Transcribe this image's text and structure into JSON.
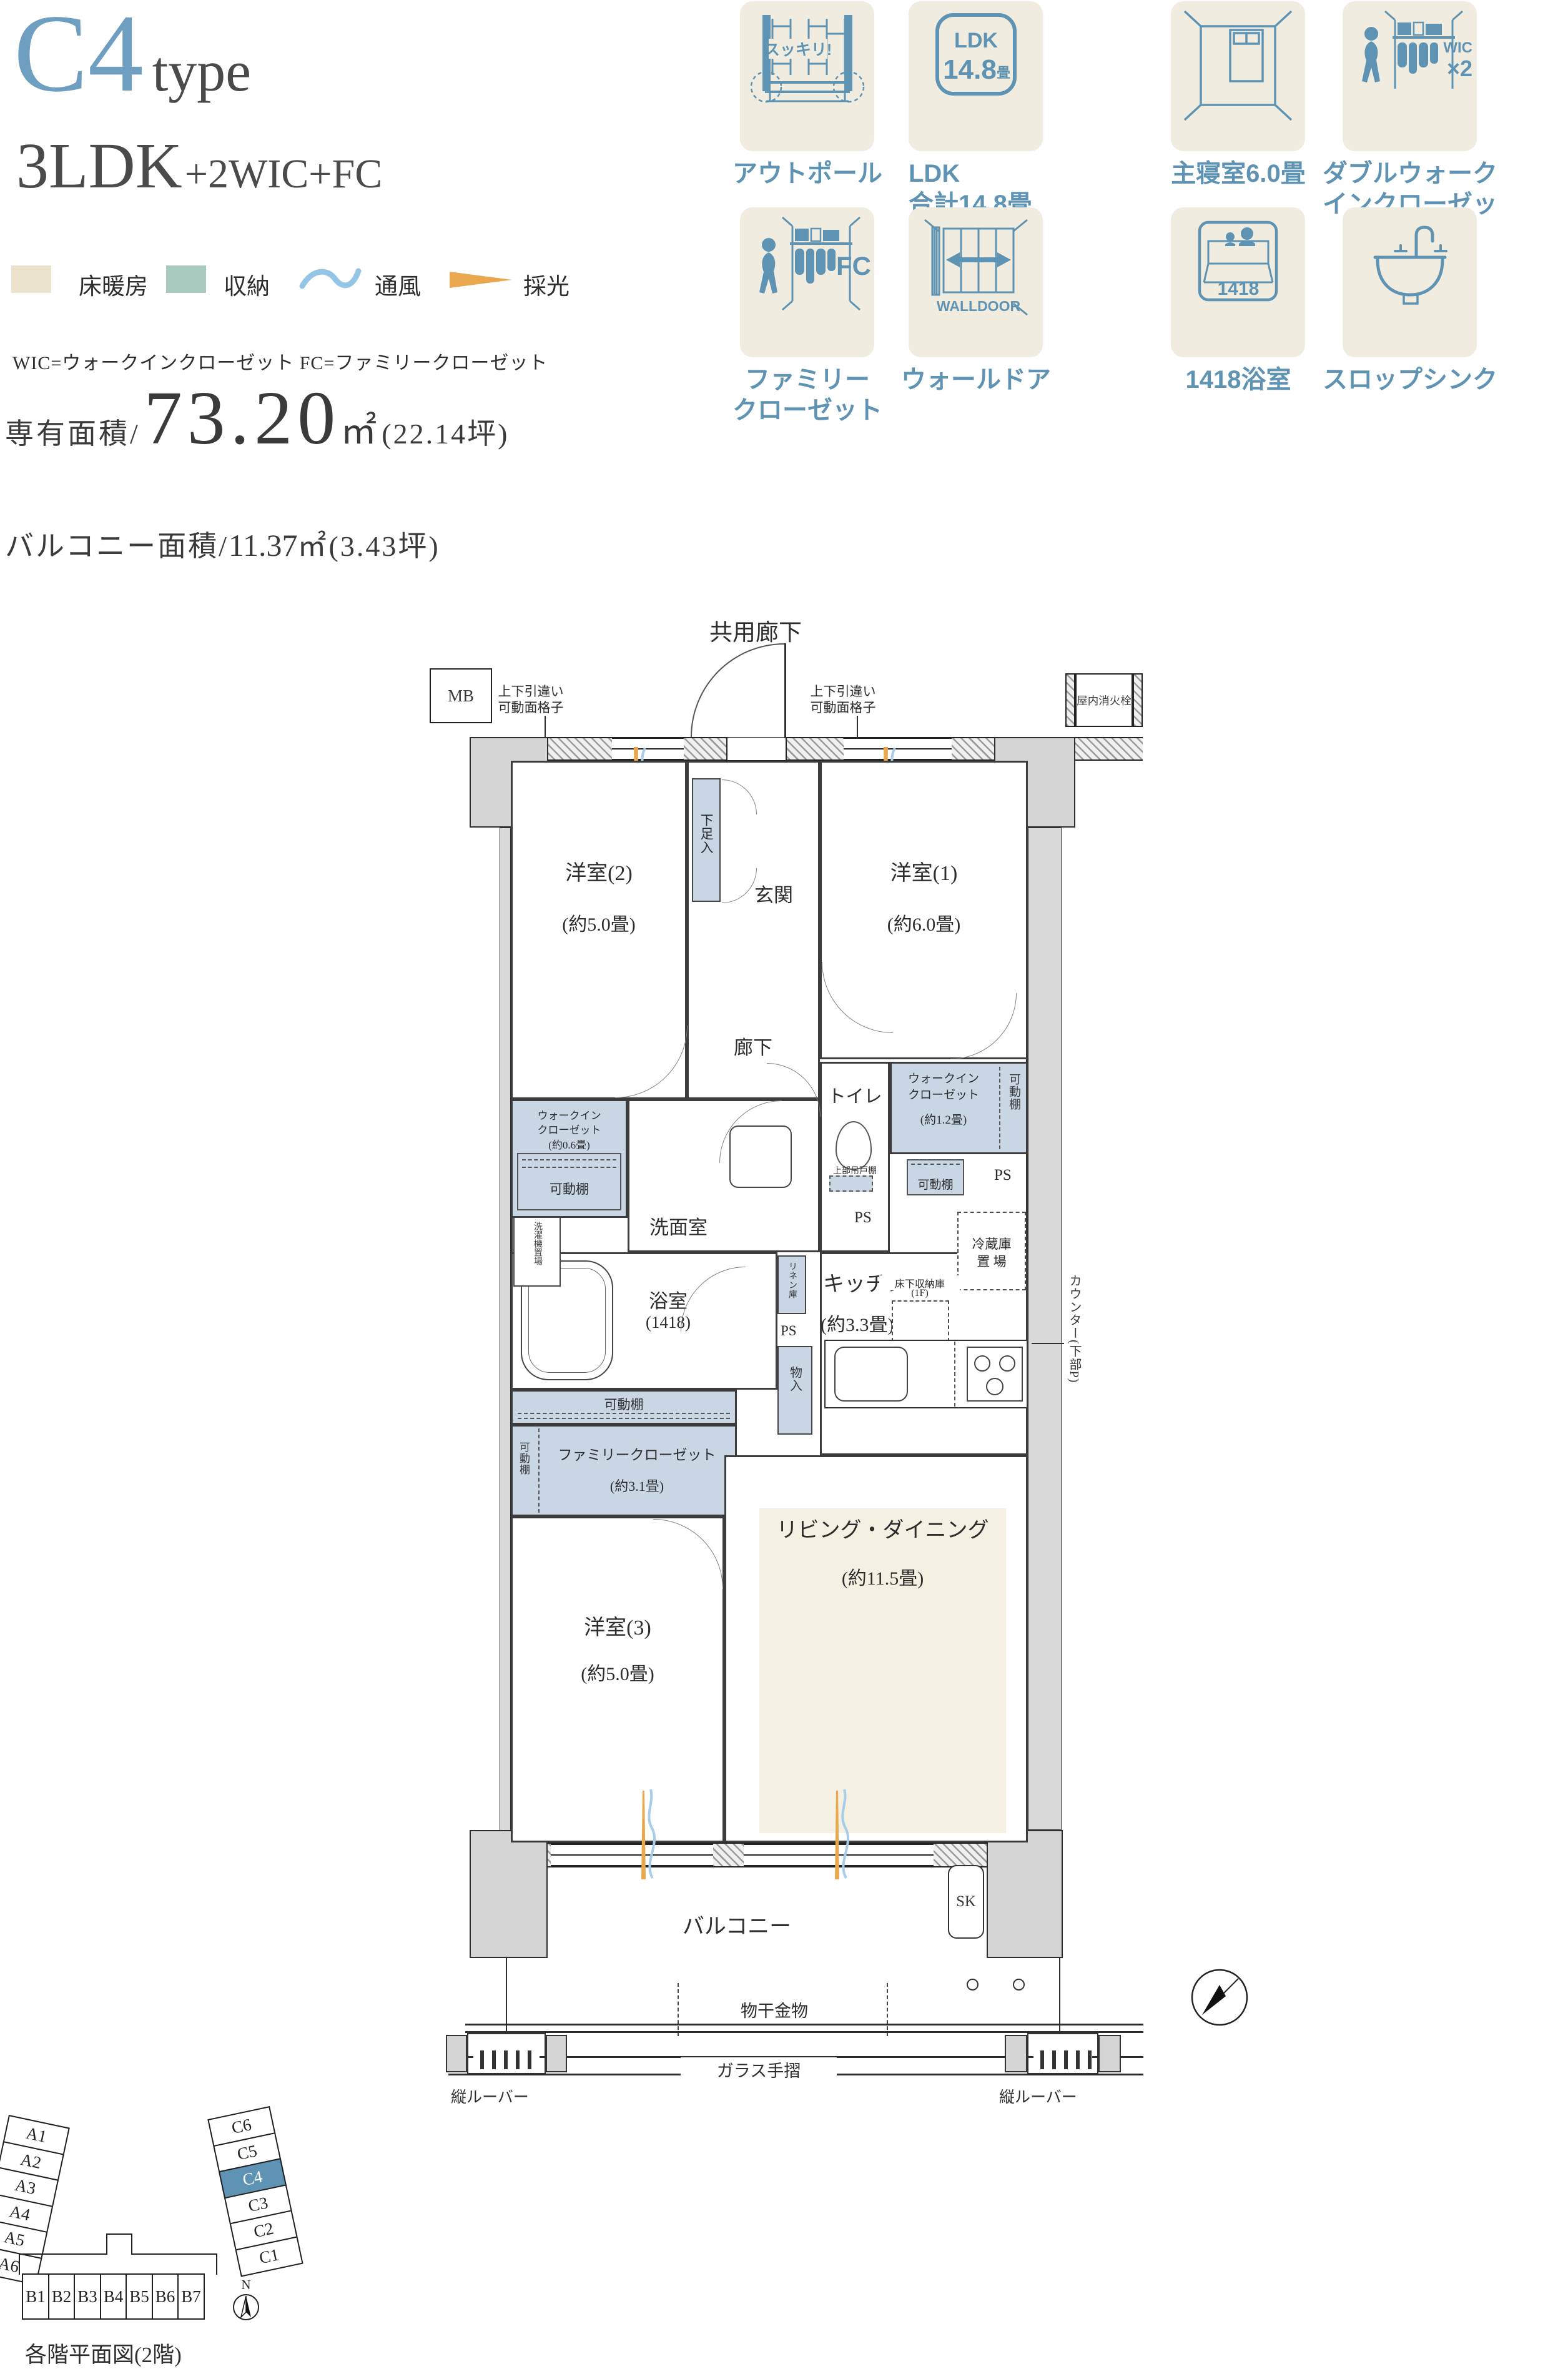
{
  "title": {
    "code": "C4",
    "word": "type",
    "plan": "3LDK",
    "plan_suffix": "+2WIC+FC"
  },
  "legend": {
    "floor_heating": "床暖房",
    "storage": "収納",
    "ventilation": "通風",
    "daylight": "採光",
    "abbr": "WIC=ウォークインクローゼット FC=ファミリークローゼット"
  },
  "area": {
    "label": "専有面積/",
    "value": "73.20",
    "unit": "㎡",
    "tsubo": "(22.14坪)"
  },
  "balcony_area": {
    "label": "バルコニー面積/",
    "value": "11.37",
    "unit": "㎡",
    "tsubo": "(3.43坪)"
  },
  "features": {
    "outpole": {
      "badge": "スッキリ!",
      "label": "アウトポール"
    },
    "ldk": {
      "icon_top": "LDK",
      "icon_num": "14.8",
      "icon_unit": "畳",
      "label_1": "LDK",
      "label_2": "合計14.8畳"
    },
    "bedroom": {
      "label": "主寝室6.0畳"
    },
    "dwic": {
      "icon_text": "WIC",
      "icon_mult": "×2",
      "label_1": "ダブルウォーク",
      "label_2": "インクローゼット"
    },
    "fc": {
      "icon_text": "FC",
      "label_1": "ファミリー",
      "label_2": "クローゼット"
    },
    "walldoor": {
      "icon_text": "WALLDOOR",
      "label": "ウォールドア"
    },
    "bath": {
      "icon_num": "1418",
      "label": "1418浴室"
    },
    "slopsink": {
      "label": "スロップシンク"
    }
  },
  "plan": {
    "common_corridor": "共用廊下",
    "mb": "MB",
    "hydrant": "屋内消火栓",
    "p": "P",
    "ps": "PS",
    "sk": "SK",
    "grille_1": "上下引違い",
    "grille_2": "可動面格子",
    "entrance": "玄関",
    "shoe_box": "下足入",
    "hallway": "廊下",
    "room2_name": "洋室(2)",
    "room2_size": "(約5.0畳)",
    "room1_name": "洋室(1)",
    "room1_size": "(約6.0畳)",
    "room3_name": "洋室(3)",
    "room3_size": "(約5.0畳)",
    "living_name": "リビング・ダイニング",
    "living_size": "(約11.5畳)",
    "kitchen_name": "キッチン",
    "kitchen_size": "(約3.3畳)",
    "washroom": "洗面室",
    "laundry": "洗濯機置場",
    "linen": "リネン庫",
    "closet_small": "物入",
    "bath_name": "浴室",
    "bath_size": "(1418)",
    "toilet": "トイレ",
    "upper_cabinet": "上部吊戸棚",
    "wic_1": "ウォークイン",
    "wic_2": "クローゼット",
    "wic06_size": "(約0.6畳)",
    "wic12_size": "(約1.2畳)",
    "shelf": "可動棚",
    "fc_name": "ファミリークローゼット",
    "fc_size": "(約3.1畳)",
    "fridge_1": "冷蔵庫",
    "fridge_2": "置 場",
    "underfloor_1": "床下収納庫",
    "underfloor_2": "(1F)",
    "counter": "カウンター(下部P)",
    "balcony": "バルコニー",
    "drying": "物干金物",
    "glass_rail": "ガラス手摺",
    "louver": "縦ルーバー"
  },
  "minimap": {
    "caption": "各階平面図(2階)",
    "north": "N",
    "a": [
      "A1",
      "A2",
      "A3",
      "A4",
      "A5",
      "A6"
    ],
    "b": [
      "B1",
      "B2",
      "B3",
      "B4",
      "B5",
      "B6",
      "B7"
    ],
    "c": [
      "C6",
      "C5",
      "C4",
      "C3",
      "C2",
      "C1"
    ]
  },
  "colors": {
    "accent": "#6f9fc0",
    "icon_blue": "#5f93b4",
    "card_bg": "#f0ece0",
    "storage": "#c9d7e4",
    "heating": "#f4f0e2",
    "legend_green": "#a9cabe",
    "legend_beige": "#ece3cd",
    "wave": "#93c5e6",
    "daylight": "#e9a84d"
  }
}
